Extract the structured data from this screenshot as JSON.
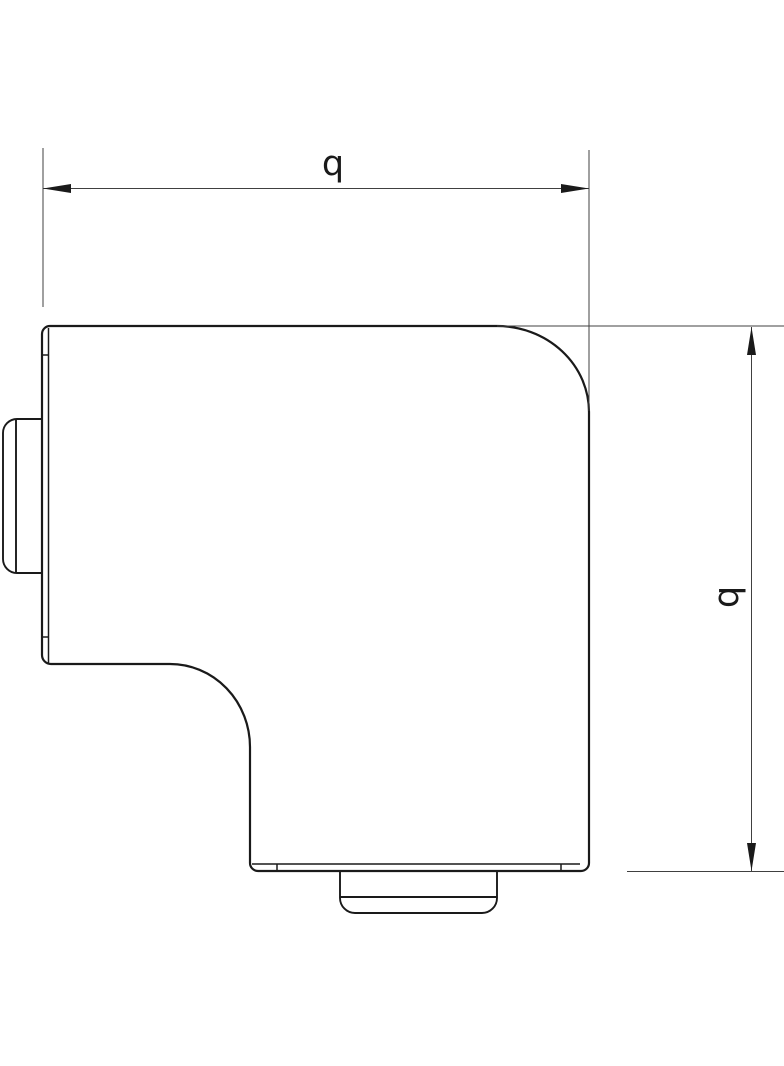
{
  "page": {
    "background": "#ffffff"
  },
  "drawing": {
    "type": "technical-line-drawing",
    "view": "flat-angle-elbow-fitting-outline-with-connector-stubs",
    "dimensions": {
      "width_label": "b",
      "height_label": "b"
    },
    "colors": {
      "outline": "#1a1a1a",
      "dimension_lines": "#404040",
      "label_text": "#1a1a1a"
    }
  }
}
